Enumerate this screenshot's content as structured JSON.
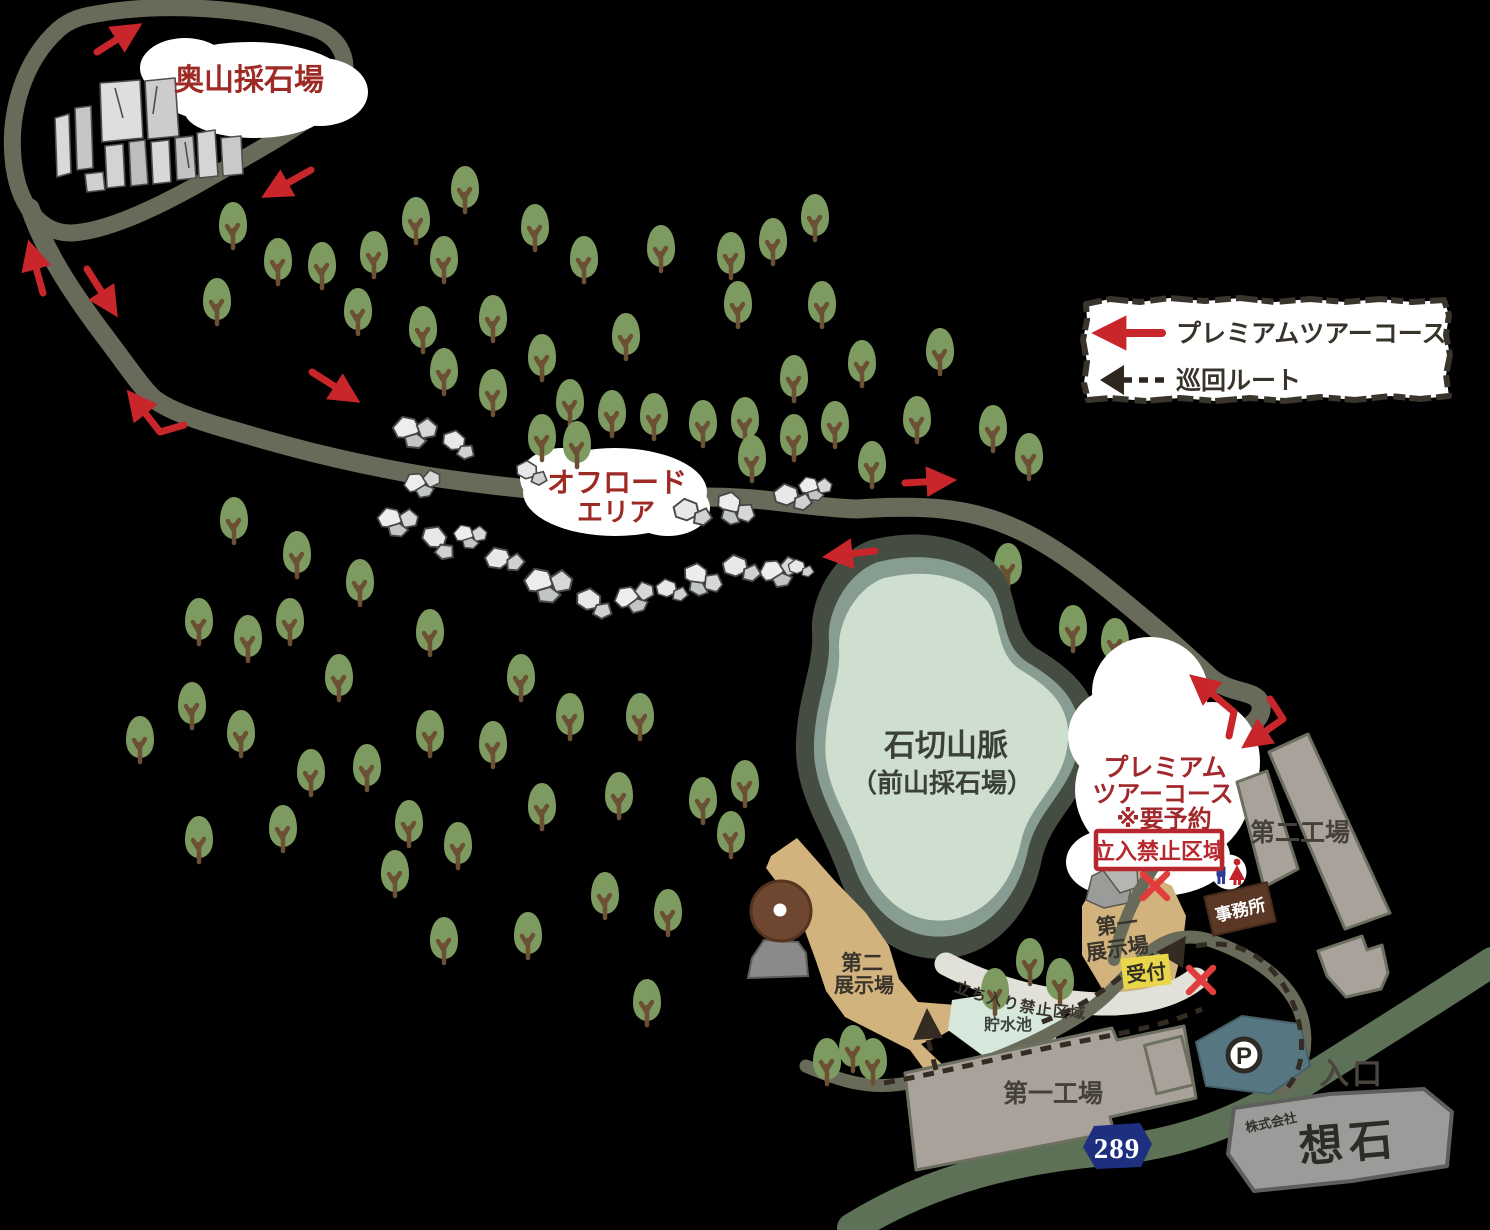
{
  "legend": {
    "premium_tour": "プレミアムツアーコース",
    "patrol_route": "巡回ルート"
  },
  "labels": {
    "okuyama_quarry": "奥山採石場",
    "offroad_line1": "オフロード",
    "offroad_line2": "エリア",
    "mountain_line1": "石切山脈",
    "mountain_line2": "（前山採石場）",
    "premium_line1": "プレミアム",
    "premium_line2": "ツアーコース",
    "premium_line3": "※要予約",
    "no_entry_zone": "立入禁止区域",
    "exhibition1_line1": "第一",
    "exhibition1_line2": "展示場",
    "reception": "受付",
    "office": "事務所",
    "factory2": "第二工場",
    "factory1": "第一工場",
    "exhibition2_line1": "第二",
    "exhibition2_line2": "展示場",
    "reservoir": "貯水池",
    "entrance": "入口",
    "walkway_no_entry": "立ち入り禁止区域",
    "route_number": "289",
    "parking": "P",
    "company_small": "株式会社",
    "company_logo": "想石"
  },
  "colors": {
    "accent_red": "#c9262c",
    "label_dark_red": "#9d2a24",
    "no_entry_red": "#b7282e",
    "road_olive": "#686b5a",
    "regional_road_green": "#5c7155",
    "tree_green": "#7d9b60",
    "lake_fill": "#cedecf",
    "exhibition_tan": "#d2b27d",
    "factory_gray": "#a9a29a",
    "reservoir_mint": "#d6e7db",
    "parking_teal": "#567682",
    "route_badge_blue": "#1e2f80",
    "office_brown": "#5b3726",
    "reception_yellow": "#e9d64b",
    "patrol_dark": "#342b23"
  },
  "map": {
    "trees": [
      [
        233,
        224
      ],
      [
        278,
        260
      ],
      [
        322,
        264
      ],
      [
        374,
        253
      ],
      [
        217,
        300
      ],
      [
        358,
        310
      ],
      [
        416,
        219
      ],
      [
        465,
        188
      ],
      [
        444,
        258
      ],
      [
        423,
        328
      ],
      [
        493,
        317
      ],
      [
        535,
        226
      ],
      [
        584,
        258
      ],
      [
        444,
        370
      ],
      [
        493,
        391
      ],
      [
        542,
        356
      ],
      [
        626,
        335
      ],
      [
        661,
        247
      ],
      [
        731,
        254
      ],
      [
        738,
        303
      ],
      [
        773,
        240
      ],
      [
        815,
        216
      ],
      [
        822,
        303
      ],
      [
        794,
        377
      ],
      [
        570,
        401
      ],
      [
        612,
        412
      ],
      [
        654,
        415
      ],
      [
        703,
        422
      ],
      [
        745,
        419
      ],
      [
        542,
        436
      ],
      [
        577,
        443
      ],
      [
        752,
        457
      ],
      [
        794,
        436
      ],
      [
        862,
        362
      ],
      [
        940,
        350
      ],
      [
        917,
        418
      ],
      [
        993,
        427
      ],
      [
        872,
        463
      ],
      [
        1029,
        455
      ],
      [
        835,
        423
      ],
      [
        234,
        519
      ],
      [
        297,
        553
      ],
      [
        360,
        581
      ],
      [
        199,
        620
      ],
      [
        248,
        637
      ],
      [
        290,
        620
      ],
      [
        430,
        631
      ],
      [
        192,
        704
      ],
      [
        140,
        738
      ],
      [
        241,
        732
      ],
      [
        339,
        676
      ],
      [
        311,
        771
      ],
      [
        367,
        766
      ],
      [
        430,
        732
      ],
      [
        493,
        743
      ],
      [
        521,
        676
      ],
      [
        570,
        715
      ],
      [
        640,
        715
      ],
      [
        199,
        838
      ],
      [
        283,
        827
      ],
      [
        409,
        822
      ],
      [
        458,
        844
      ],
      [
        395,
        872
      ],
      [
        542,
        805
      ],
      [
        619,
        794
      ],
      [
        703,
        799
      ],
      [
        745,
        782
      ],
      [
        731,
        833
      ],
      [
        444,
        939
      ],
      [
        528,
        934
      ],
      [
        605,
        894
      ],
      [
        668,
        911
      ],
      [
        647,
        1001
      ],
      [
        1008,
        565
      ],
      [
        1073,
        627
      ],
      [
        1115,
        640
      ],
      [
        1140,
        693
      ],
      [
        1172,
        690
      ],
      [
        1148,
        737
      ],
      [
        1120,
        735
      ]
    ],
    "trees_front": [
      [
        995,
        990
      ],
      [
        1030,
        960
      ],
      [
        1060,
        980
      ],
      [
        827,
        1060
      ],
      [
        853,
        1047
      ],
      [
        873,
        1060
      ]
    ],
    "rocks": [
      [
        412,
        430,
        1.2,
        0
      ],
      [
        455,
        443,
        1.1,
        20
      ],
      [
        420,
        483,
        1.0,
        -15
      ],
      [
        528,
        472,
        1.0,
        10
      ],
      [
        395,
        520,
        1.1,
        0
      ],
      [
        435,
        540,
        1.2,
        30
      ],
      [
        468,
        535,
        0.9,
        0
      ],
      [
        500,
        560,
        1.2,
        -10
      ],
      [
        545,
        583,
        1.3,
        0
      ],
      [
        590,
        602,
        1.2,
        15
      ],
      [
        632,
        597,
        1.1,
        -20
      ],
      [
        668,
        590,
        1.0,
        0
      ],
      [
        700,
        578,
        1.1,
        25
      ],
      [
        737,
        568,
        1.2,
        0
      ],
      [
        777,
        571,
        1.1,
        -15
      ],
      [
        688,
        512,
        1.2,
        0
      ],
      [
        733,
        507,
        1.1,
        30
      ],
      [
        788,
        497,
        1.2,
        0
      ],
      [
        813,
        487,
        0.9,
        0
      ],
      [
        798,
        568,
        0.8,
        0
      ]
    ]
  }
}
